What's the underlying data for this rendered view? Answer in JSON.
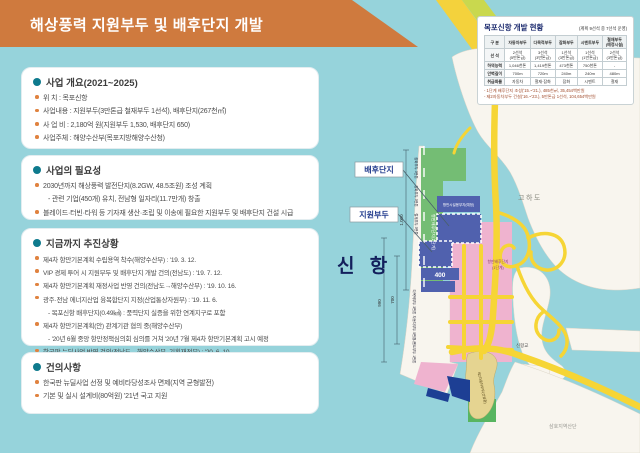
{
  "title": "해상풍력 지원부두 및 배후단지 개발",
  "colors": {
    "banner": "#cf7a3e",
    "sea": "#96d3db",
    "road": "#f6d535",
    "zone_green": "#74bd74",
    "zone_blue": "#5061ae",
    "zone_pink": "#efb3cf",
    "zone_darkblue": "#1d3f94",
    "zone_tan": "#e5d491",
    "bullet_teal": "#0e7a8d",
    "bullet_orange": "#e0823f"
  },
  "boxes": [
    {
      "heading": "사업 개요(2021~2025)",
      "items": [
        {
          "t": "위    치 : 목포신항"
        },
        {
          "t": "사업내용 : 지원부두(3만톤급 철재부두 1선석), 배후단지(267천㎡)"
        },
        {
          "t": "사 업 비 : 2,180억 원(지원부두 1,530, 배후단지 650)"
        },
        {
          "t": "사업주체 : 해양수산부(목포지방해양수산청)"
        }
      ]
    },
    {
      "heading": "사업의 필요성",
      "items": [
        {
          "t": "2030년까지 해상풍력 발전단지(8.2GW, 48.5조원) 조성 계획"
        },
        {
          "t": "- 관련 기업(450개) 유치, 전남형 일자리(11.7만개) 창출",
          "sub": true
        },
        {
          "t": "블레이드·터빈·타워 등 기자재 생산·조립 및 이송에 필요한 지원부두 및 배후단지 건설 시급"
        }
      ]
    },
    {
      "heading": "지금까지 추진상황",
      "items": [
        {
          "t": "제4차 항만기본계획 수립용역 착수(해양수산부) : '19. 3. 12."
        },
        {
          "t": "VIP 경제 투어 시 지원부두 및 배후단지 개발 건의(전남도) : '19. 7. 12."
        },
        {
          "t": "제4차 항만기본계획 재정사업 반영 건의(전남도→해양수산부) : '19. 10. 16."
        },
        {
          "t": "광주·전남 에너지산업 융복합단지 지정(산업통상자원부) : '19. 11. 6."
        },
        {
          "t": "- 목포신항 배후단지(0.49㎢) : 풍력단지 실증을 위한 연계지구로 포함",
          "sub": true
        },
        {
          "t": "제4차 항만기본계획(안) 관계기관 협의 중(해양수산부)"
        },
        {
          "t": "- '20년 6월 중앙 항만정책심의회 심의를 거쳐 '20년 7월 제4차 항만기본계획 고시 예정",
          "sub": true
        },
        {
          "t": "한국판 뉴딜사업 반영 건의(전남도→해양수산부, 기획재정부) : '20. 6. 10."
        }
      ]
    },
    {
      "heading": "건의사항",
      "items": [
        {
          "t": "한국판 뉴딜사업 선정 및 예비타당성조사 면제(지역 균형발전)"
        },
        {
          "t": "기본 및 실시 설계비(80억원) '21년 국고 지원"
        }
      ]
    }
  ],
  "table": {
    "title": "목포신항 개발 현황",
    "note": "(계획 9선석 중 7선석 운영)",
    "headers": [
      "구 분",
      "자동차부두",
      "다목적부두",
      "잡화부두",
      "시멘트부두",
      "철재부두\n(예정시설)"
    ],
    "rows": [
      {
        "label": "선 석",
        "cells": [
          "2선석\n(5만톤급)",
          "3선석\n(3만톤급)",
          "1선석\n(3만톤급)",
          "1선석\n(1만톤급)",
          "2선석\n(3만톤급)"
        ]
      },
      {
        "label": "하역능력",
        "cells": [
          "1,046천톤",
          "1,419천톤",
          "473천톤",
          "750천톤",
          "-"
        ]
      },
      {
        "label": "안벽길이",
        "cells": [
          "700m",
          "720m",
          "240m",
          "240m",
          "480m"
        ]
      },
      {
        "label": "취급화물",
        "cells": [
          "자동차",
          "철재·잡화",
          "잡화",
          "시멘트",
          "철재"
        ]
      }
    ],
    "footnotes": [
      "- 1단계 배후단지 조성('15.~'21.), 485천㎡, 35,454백만원",
      "- 제2자동차부두 건설('16.~'23.), 5만톤급 1선석, 104,654백만원"
    ]
  },
  "map": {
    "sinhang": "신 항",
    "gohado": "고하도",
    "bridge": "신항교",
    "samho": "삼호지역산단",
    "callout_baehu": "배후단지",
    "callout_jiwon": "지원부두",
    "zones": {
      "green2": "항만배후단지(2단계)",
      "blue_site": "항만시설용부지(예정)",
      "pink1a": "항만배후단지",
      "pink1b": "(1단계)",
      "tan": "제2자동차부두(건설중)",
      "band": "400"
    },
    "dims": {
      "d1": "990",
      "d2": "700",
      "d3": "1,000"
    },
    "berths": [
      "잡화부두 3만톤",
      "잡화부두 3만톤",
      "철재부두 3만톤",
      "다목적부두 3만톤",
      "자동차부두 5만톤",
      "시멘트부두 1만톤"
    ]
  }
}
